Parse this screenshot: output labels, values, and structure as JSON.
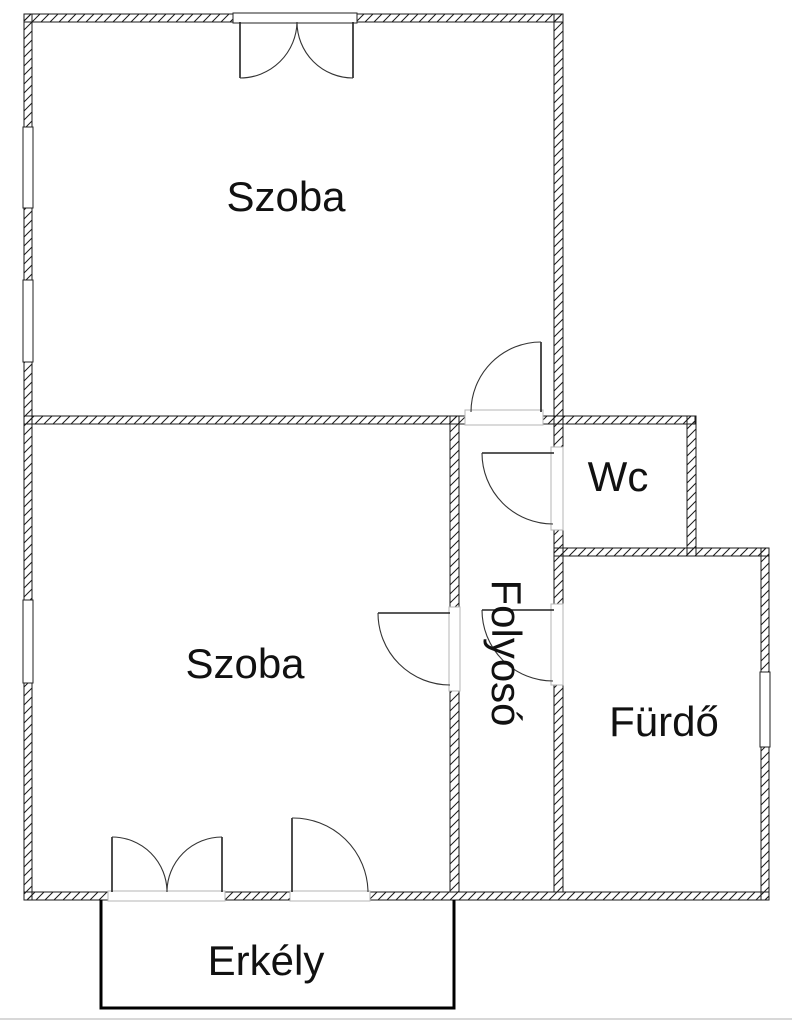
{
  "plan": {
    "title": "apartment-floor-plan",
    "rooms": [
      {
        "id": "szoba-top",
        "label": "Szoba"
      },
      {
        "id": "szoba-bottom",
        "label": "Szoba"
      },
      {
        "id": "wc",
        "label": "Wc"
      },
      {
        "id": "folyoso",
        "label": "Folyosó",
        "orientation": "vertical"
      },
      {
        "id": "furdo",
        "label": "Fürdő"
      },
      {
        "id": "erkely",
        "label": "Erkély"
      }
    ],
    "features": {
      "doors": [
        "double-window-top-wall",
        "door-top-szoba-to-folyoso",
        "door-folyoso-to-wc",
        "door-folyoso-to-furdo",
        "door-folyoso-to-bottom-szoba",
        "double-balcony-door-bottom-wall",
        "single-balcony-door-bottom-wall"
      ],
      "windows": [
        "window-left-wall-upper-1",
        "window-left-wall-upper-2",
        "window-left-wall-lower",
        "window-right-wall-furdo"
      ]
    },
    "colors": {
      "background": "#ffffff",
      "wall_line": "#1a1a1a",
      "hatch_line": "#1a1a1a",
      "door_line": "#222222",
      "opening_line": "#b5b5b5",
      "label_text": "#111111",
      "balcony_line": "#000000",
      "footer_line": "#d8d8d8"
    }
  }
}
